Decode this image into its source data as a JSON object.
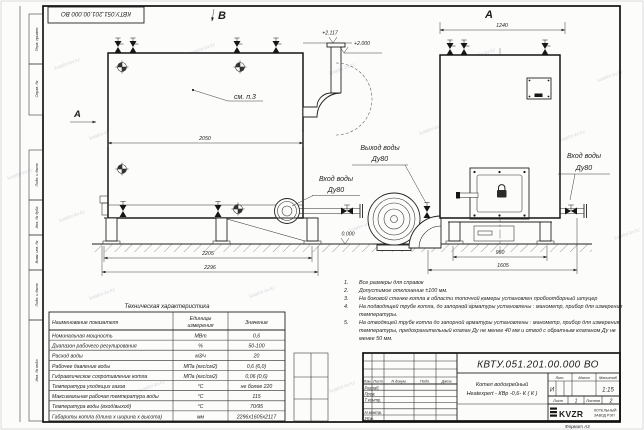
{
  "watermark": "kotelni-kv.kz",
  "stamp": {
    "doc_number_top": "КВТУ.051.201.00.000  ВО"
  },
  "margin_fields": {
    "top": [
      "Перв. примен.",
      "Справ. №"
    ],
    "bottom": [
      "Подп. и дата",
      "Инв. № дубл.",
      "Взам. инв. №",
      "Подп. и дата",
      "Инв. № подл."
    ]
  },
  "views": {
    "label_b": "В",
    "label_a_top": "А",
    "label_a_side": "А",
    "note_ref": "см. п.3",
    "outlet_label1": "Выход воды",
    "outlet_label2": "Ду80",
    "inlet_left_label1": "Вход воды",
    "inlet_left_label2": "Ду80",
    "inlet_right_label1": "Вход воды",
    "inlet_right_label2": "Ду80",
    "elev_plus2117": "+2.117",
    "elev_plus2000": "+2.000",
    "elev_zero": "0.000",
    "dims": {
      "body_length": "2050",
      "frame_length": "2205",
      "overall_length": "2296",
      "body_width": "1240",
      "frame_width": "960",
      "overall_width": "1605"
    }
  },
  "notes": {
    "lines": [
      {
        "num": "1.",
        "text": "Все размеры для справок"
      },
      {
        "num": "2.",
        "text": "Допустимое отклонение  ±100 мм."
      },
      {
        "num": "3.",
        "text": "На боковой стенке котла в области топочной камеры установлен пробоотборный штуцер"
      },
      {
        "num": "4.",
        "text": "На  подводящей трубе котла, до запорной арматуры установлены : манометр, прибор для измерения"
      },
      {
        "num": "",
        "text": "температуры."
      },
      {
        "num": "5.",
        "text": "На отводящей трубе котла до запорной арматуры установлены : манометр, прибор для измерения"
      },
      {
        "num": "",
        "text": "температуры, предохранительный клапан  Ду не менее 40 мм и отвод с обратным клапаном  Ду не"
      },
      {
        "num": "",
        "text": "менее 50 мм."
      }
    ]
  },
  "tech_table": {
    "title": "Техническая характеристика",
    "header": {
      "name": "Наименование показателя",
      "units1": "Единицы",
      "units2": "измерения",
      "value": "Значение"
    },
    "rows": [
      {
        "name": "Номинальная мощность",
        "unit": "МВт",
        "value": "0,6"
      },
      {
        "name": "Диапазон рабочего регулирования",
        "unit": "%",
        "value": "50-100"
      },
      {
        "name": "Расход воды",
        "unit": "м3/ч",
        "value": "20"
      },
      {
        "name": "Рабочее давление воды",
        "unit": "МПа (кгс/см2)",
        "value": "0,6 (6,0)"
      },
      {
        "name": "Гидравлическое сопротивление котла",
        "unit": "МПа (кгс/см2)",
        "value": "0,06 (0,6)"
      },
      {
        "name": "Температура уходящих газов",
        "unit": "°С",
        "value": "не более 220"
      },
      {
        "name": "Максимальная рабочая температура воды",
        "unit": "°С",
        "value": "115"
      },
      {
        "name": "Температура воды (вход/выход)",
        "unit": "°С",
        "value": "70/95"
      },
      {
        "name": "Габариты котла (длина х ширина х высота)",
        "unit": "мм",
        "value": "2296х1605х2117"
      }
    ]
  },
  "title_block": {
    "doc_number": "КВТУ.051.201.00.000  ВО",
    "product_name1": "Котел водогрейный",
    "product_name2": "Heatexpert - КВр -0,6- К ( К )",
    "cols": {
      "izm": "Изм.",
      "list": "Лист",
      "ndoc": "N докум.",
      "podp": "Подп.",
      "data": "Дата"
    },
    "rows": {
      "razrab": "Разраб.",
      "prov": "Пров.",
      "tkontr": "Т.контр.",
      "nkontr": "Н.контр.",
      "utv": "Утв."
    },
    "lit_label": "Лит.",
    "mass_label": "Масса",
    "scale_label": "Масштаб",
    "lit_value": "И",
    "scale_value": "1:15",
    "sheet_label": "Лист",
    "sheet_value": "1",
    "sheets_label": "Листов",
    "sheets_value": "2",
    "logo_text": "KVZR",
    "company1": "КОТЕЛЬНЫЙ",
    "company2": "ЗАВОД РЭП",
    "format_label": "Формат  А3"
  }
}
